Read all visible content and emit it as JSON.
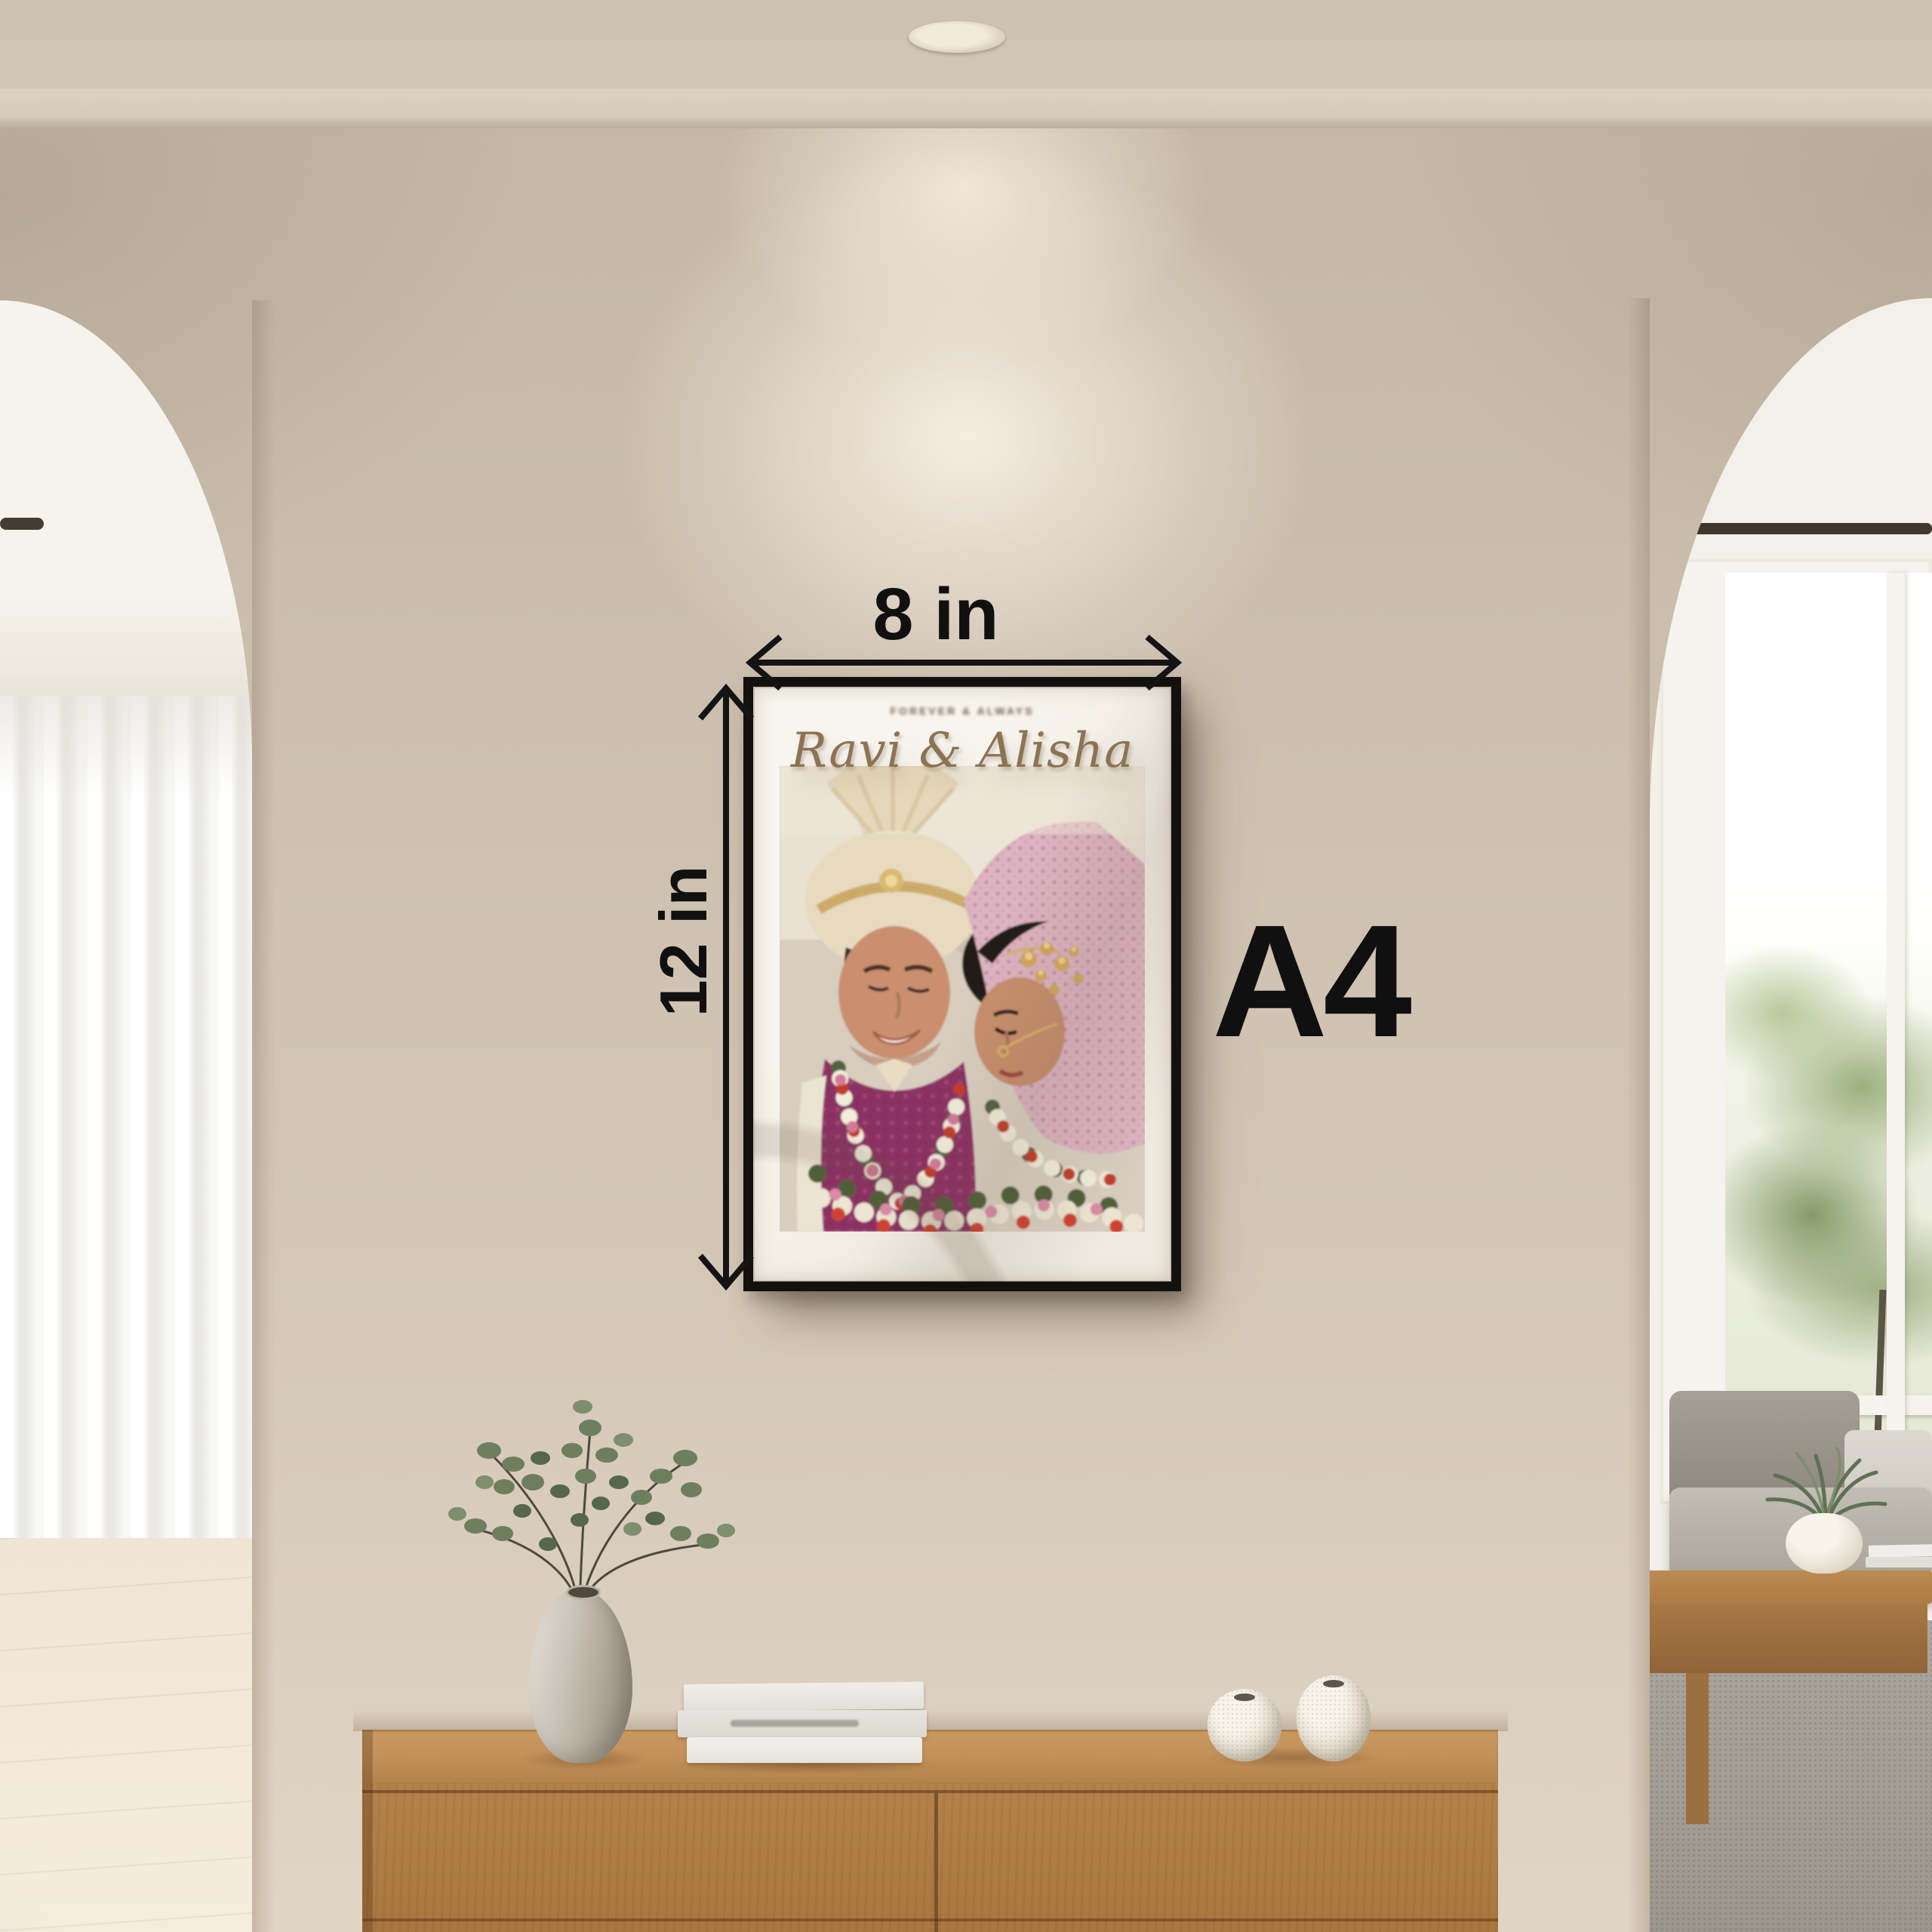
{
  "annotations": {
    "width_label": "8 in",
    "height_label": "12 in",
    "paper_size_label": "A4",
    "arrow_color": "#141414"
  },
  "frame": {
    "caption_text": "FOREVER & ALWAYS",
    "title_text": "Ravi & Alisha",
    "title_color": "#8c7354",
    "frame_color": "#13110f",
    "mat_color": "#f6f3ec",
    "subject": "wedding-couple-photo"
  },
  "palette": {
    "wall": "#cabdac",
    "wall_glow": "#f4ebdc",
    "ceiling": "#cdc1b1",
    "arch_interior": "#f6f3ed",
    "curtain_white": "#f4f3f1",
    "floor_wood": "#efe5d3",
    "console_wood": "#b5814a",
    "vase_gray": "#c9c3b7",
    "book_white": "#eceae5",
    "round_vase_white": "#ece7dc",
    "sofa_gray": "#a09a91",
    "rug_gray": "#a5a098",
    "coffee_table_wood": "#ad7b45",
    "foliage_green": "#8fa376",
    "plant_green": "#5f7155"
  }
}
